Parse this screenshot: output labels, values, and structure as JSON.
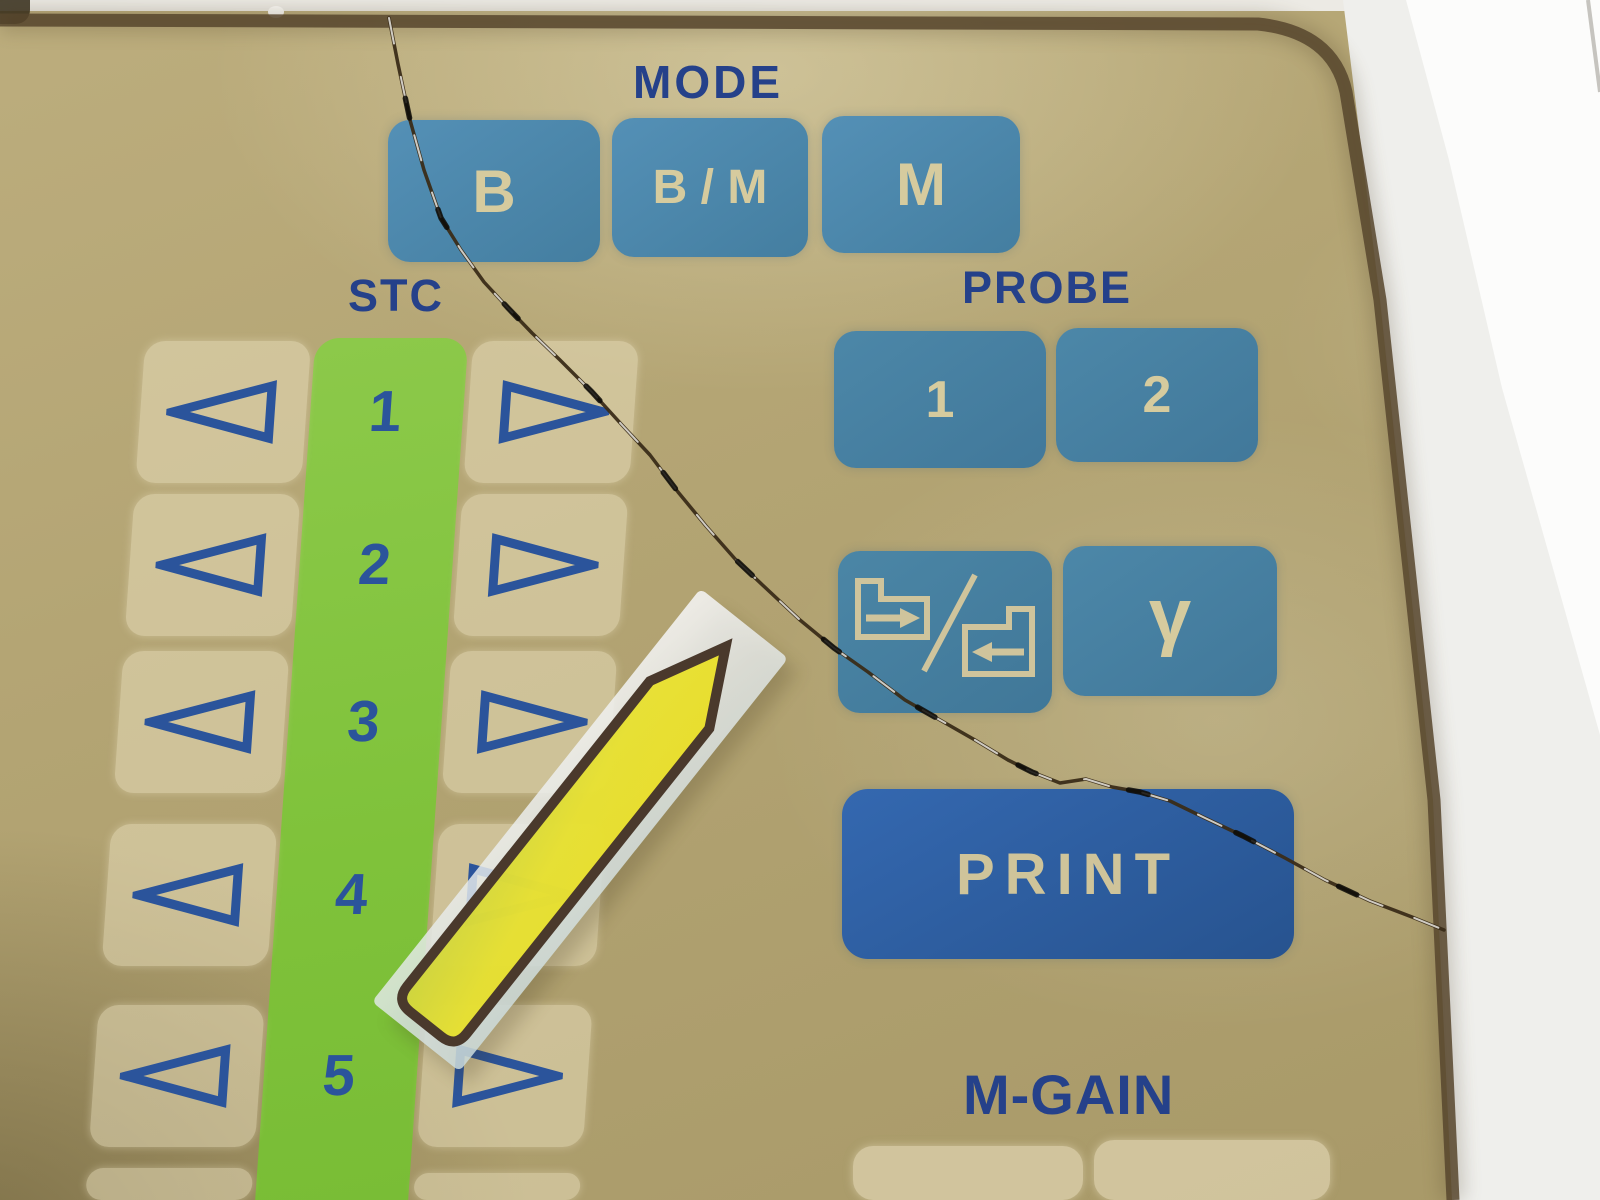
{
  "panel": {
    "title": "ultrasound scanner membrane control panel",
    "mode": {
      "label": "MODE",
      "buttons": [
        {
          "label": "B"
        },
        {
          "label": "B / M"
        },
        {
          "label": "M"
        }
      ]
    },
    "stc": {
      "label": "STC",
      "rows": [
        {
          "number": "1"
        },
        {
          "number": "2"
        },
        {
          "number": "3"
        },
        {
          "number": "4"
        },
        {
          "number": "5"
        }
      ],
      "arrow_left_icon": "triangle-left-icon",
      "arrow_right_icon": "triangle-right-icon"
    },
    "probe": {
      "label": "PROBE",
      "buttons": [
        {
          "label": "1"
        },
        {
          "label": "2"
        }
      ],
      "direction_button_icon": "probe-direction-swap-icon",
      "gamma_label": "γ"
    },
    "print": {
      "label": "PRINT"
    },
    "mgain": {
      "label": "M-GAIN"
    }
  },
  "sticker": {
    "icon": "yellow-arrow-sticker",
    "direction": "up-right"
  },
  "damage": {
    "icon": "crack-line"
  },
  "colors": {
    "panel_tan": "#b3a473",
    "key_blue": "#4c87a8",
    "print_blue": "#2c5fa5",
    "label_navy": "#25418a",
    "strip_green": "#7fc23a",
    "key_cream_overlay": "#ece1c0",
    "button_text_cream": "#d6cb9e",
    "sticker_yellow": "#e6de20",
    "sticker_outline": "#4a392c",
    "bezel_gray": "#e3e2de"
  }
}
